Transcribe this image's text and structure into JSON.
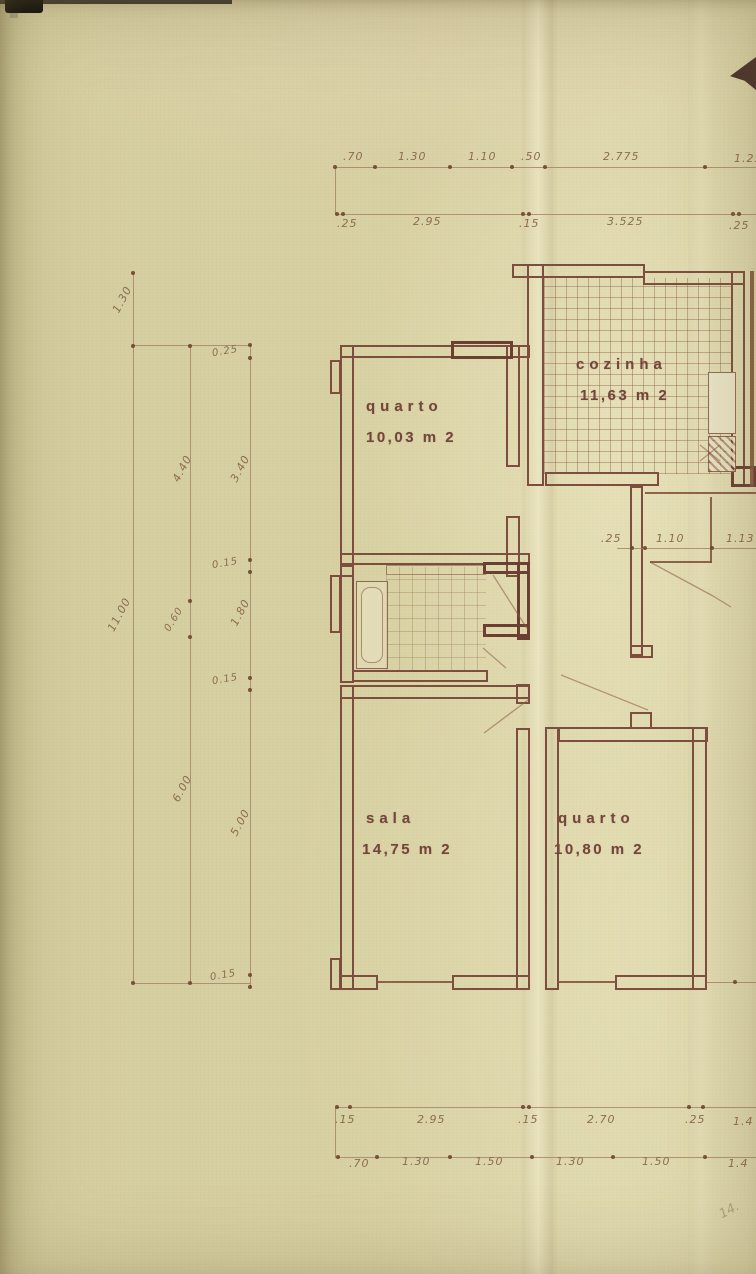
{
  "sheet": {
    "rooms": [
      {
        "name": "quarto",
        "area": "10,03 m 2"
      },
      {
        "name": "cozinha",
        "area": "11,63 m 2"
      },
      {
        "name": "sala",
        "area": "14,75 m 2"
      },
      {
        "name": "quarto",
        "area": "10,80 m 2"
      }
    ],
    "dimensions": {
      "top_row_outer": [
        ".70",
        "1.30",
        "1.10",
        ".50",
        "2.775",
        "1.25"
      ],
      "top_row_inner": [
        ".25",
        "2.95",
        ".15",
        "3.525",
        ".25"
      ],
      "left_col_outer": [
        "1.30",
        "11.00"
      ],
      "left_col_mid": [
        "4.40",
        "0.60",
        "6.00"
      ],
      "left_col_inner": [
        "0.25",
        "3.40",
        "0.15",
        "1.80",
        "0.15",
        "5.00",
        "0.15"
      ],
      "hall_row": [
        ".25",
        "1.10",
        "1.13"
      ],
      "bottom_row_inner": [
        ".15",
        "2.95",
        ".15",
        "2.70",
        ".25",
        "1.4"
      ],
      "bottom_row_outer": [
        ".70",
        "1.30",
        "1.50",
        "1.30",
        "1.50",
        "1.4"
      ],
      "handwritten_note": "14."
    },
    "colors": {
      "paper": "#d9d2a6",
      "ink": "#7a4a3c",
      "pencil": "#8d6c52"
    }
  }
}
